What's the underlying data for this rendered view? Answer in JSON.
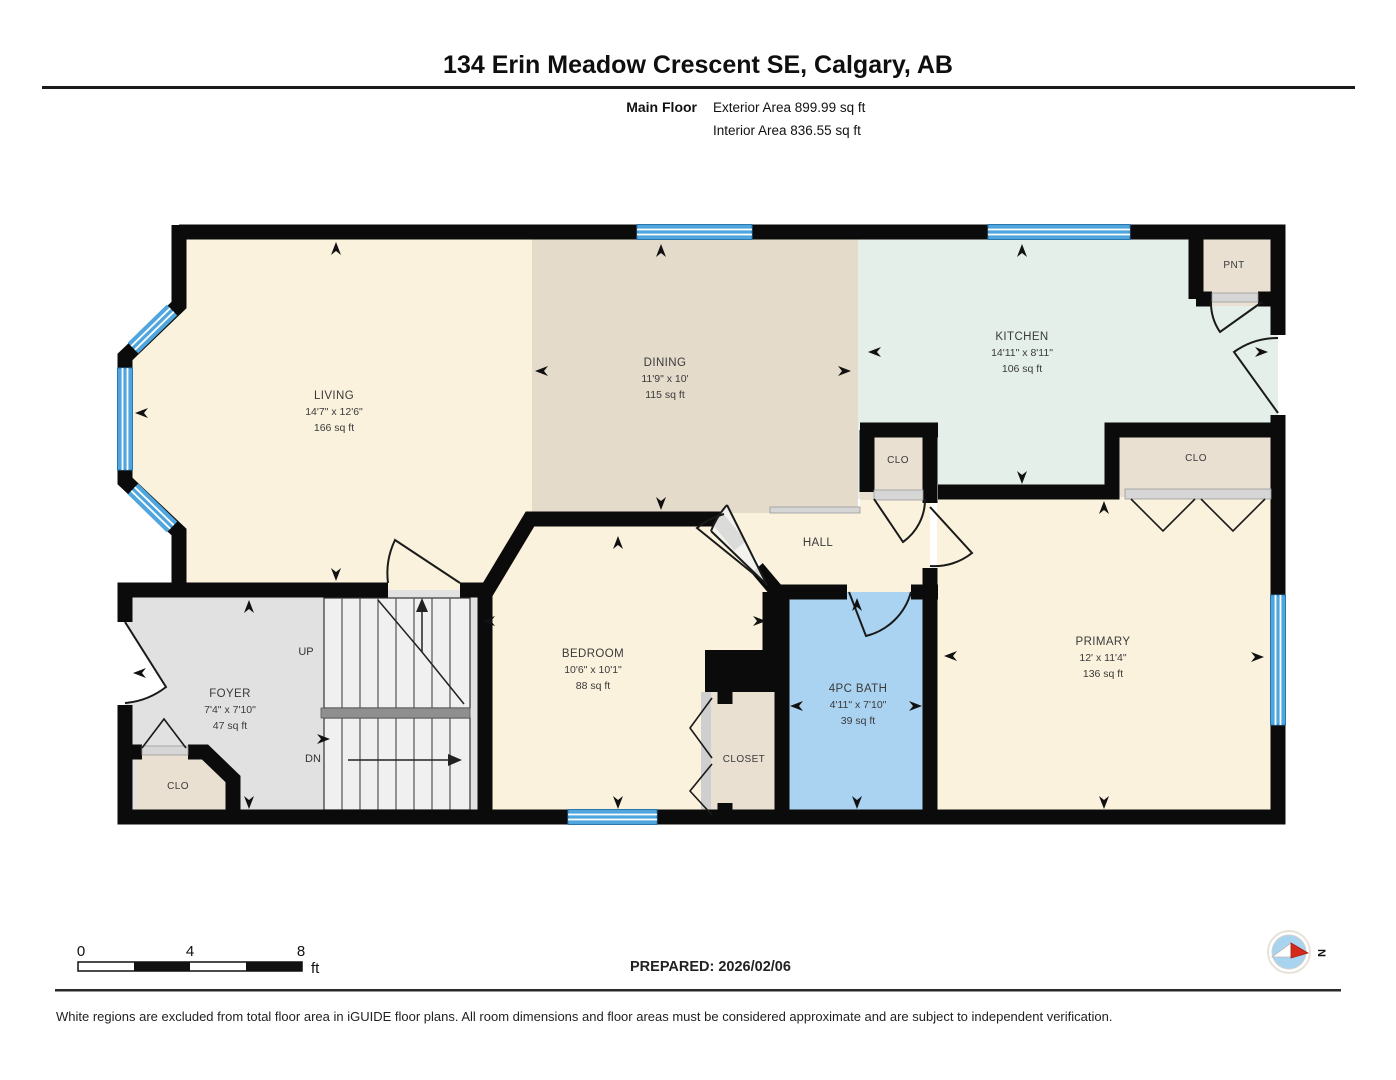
{
  "header": {
    "title": "134 Erin Meadow Crescent SE, Calgary, AB",
    "floor_label": "Main Floor",
    "exterior_area": "Exterior Area 899.99 sq ft",
    "interior_area": "Interior Area 836.55 sq ft"
  },
  "rooms": {
    "living": {
      "name": "LIVING",
      "dims": "14'7\" x 12'6\"",
      "area": "166 sq ft"
    },
    "dining": {
      "name": "DINING",
      "dims": "11'9\" x 10'",
      "area": "115 sq ft"
    },
    "kitchen": {
      "name": "KITCHEN",
      "dims": "14'11\" x 8'11\"",
      "area": "106 sq ft"
    },
    "foyer": {
      "name": "FOYER",
      "dims": "7'4\" x 7'10\"",
      "area": "47 sq ft"
    },
    "bedroom": {
      "name": "BEDROOM",
      "dims": "10'6\" x 10'1\"",
      "area": "88 sq ft"
    },
    "bath": {
      "name": "4PC BATH",
      "dims": "4'11\" x 7'10\"",
      "area": "39 sq ft"
    },
    "primary": {
      "name": "PRIMARY",
      "dims": "12' x 11'4\"",
      "area": "136 sq ft"
    },
    "hall": {
      "name": "HALL"
    },
    "pantry": {
      "name": "PNT"
    },
    "closet_hall": {
      "name": "CLO"
    },
    "closet_primary": {
      "name": "CLO"
    },
    "closet_foyer": {
      "name": "CLO"
    },
    "closet_bedroom": {
      "name": "CLOSET"
    },
    "stairs": {
      "up": "UP",
      "down": "DN"
    }
  },
  "footer": {
    "scale": {
      "t0": "0",
      "t4": "4",
      "t8": "8",
      "unit": "ft"
    },
    "prepared": "PREPARED: 2026/02/06",
    "compass": "N",
    "disclaimer": "White regions are excluded from total floor area in iGUIDE floor plans. All room dimensions and floor areas must be considered approximate and are subject to independent verification."
  },
  "colors": {
    "wall": "#0b0b0b",
    "window": "#4FA6DE",
    "cream": "#FAF2DC",
    "tan": "#E4DBCB",
    "mint": "#E4EFE9",
    "beige": "#EAE0D2",
    "gray": "#E1E1E2",
    "bath_blue": "#AAD3F1",
    "stairs": "#F0F0F0"
  }
}
